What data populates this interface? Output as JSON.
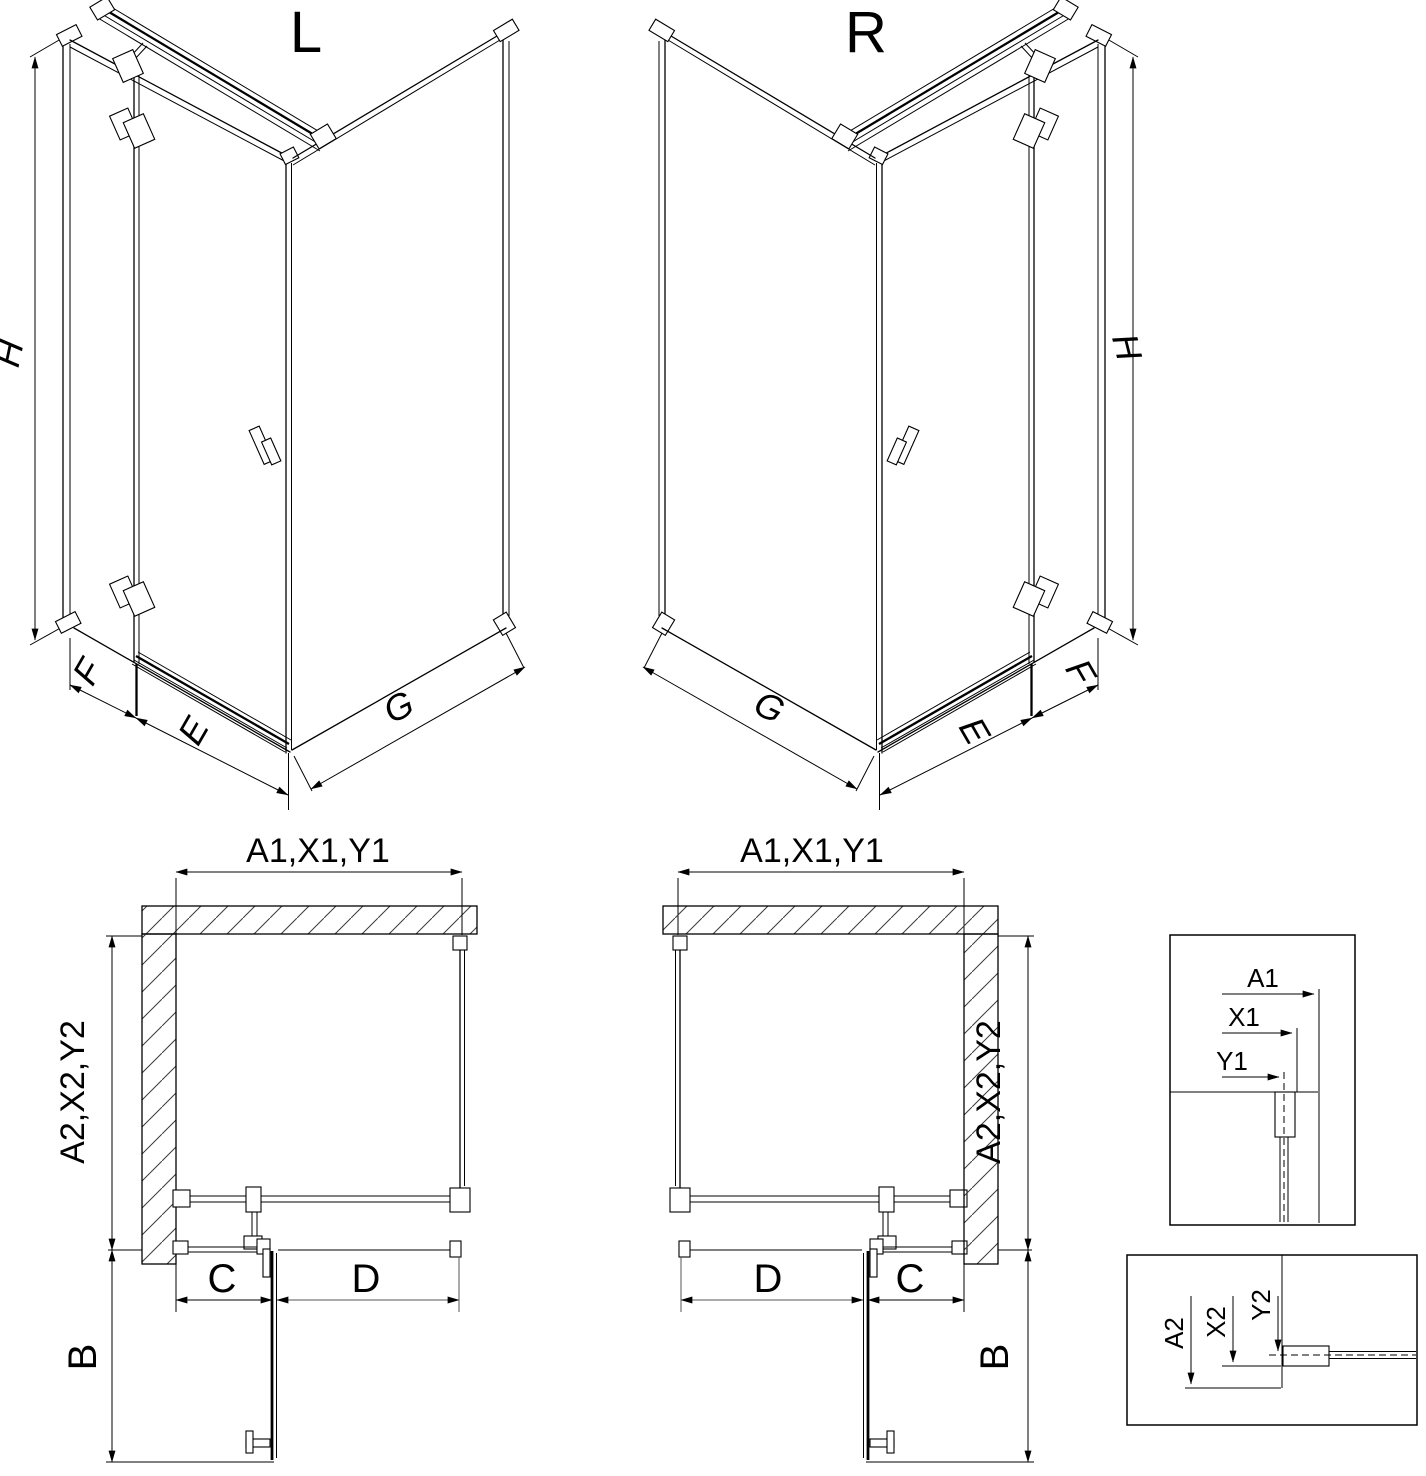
{
  "drawing": {
    "type": "technical-line-drawing",
    "subject": "corner shower enclosure, left and right hand versions, isometric and plan views with dimension keys",
    "colors": {
      "line": "#000000",
      "background": "#ffffff"
    }
  },
  "iso_left": {
    "label": "L",
    "dim_height": "H",
    "dim_side": "F",
    "dim_door": "E",
    "dim_wall": "G"
  },
  "iso_right": {
    "label": "R",
    "dim_height": "H",
    "dim_side": "F",
    "dim_door": "E",
    "dim_wall": "G"
  },
  "plan_left": {
    "dim_width": "A1,X1,Y1",
    "dim_depth": "A2,X2,Y2",
    "dim_c": "C",
    "dim_d": "D",
    "dim_b": "B"
  },
  "plan_right": {
    "dim_width": "A1,X1,Y1",
    "dim_depth": "A2,X2,Y2",
    "dim_c": "C",
    "dim_d": "D",
    "dim_b": "B"
  },
  "detail_width": {
    "a1": "A1",
    "x1": "X1",
    "y1": "Y1"
  },
  "detail_depth": {
    "a2": "A2",
    "x2": "X2",
    "y2": "Y2"
  }
}
